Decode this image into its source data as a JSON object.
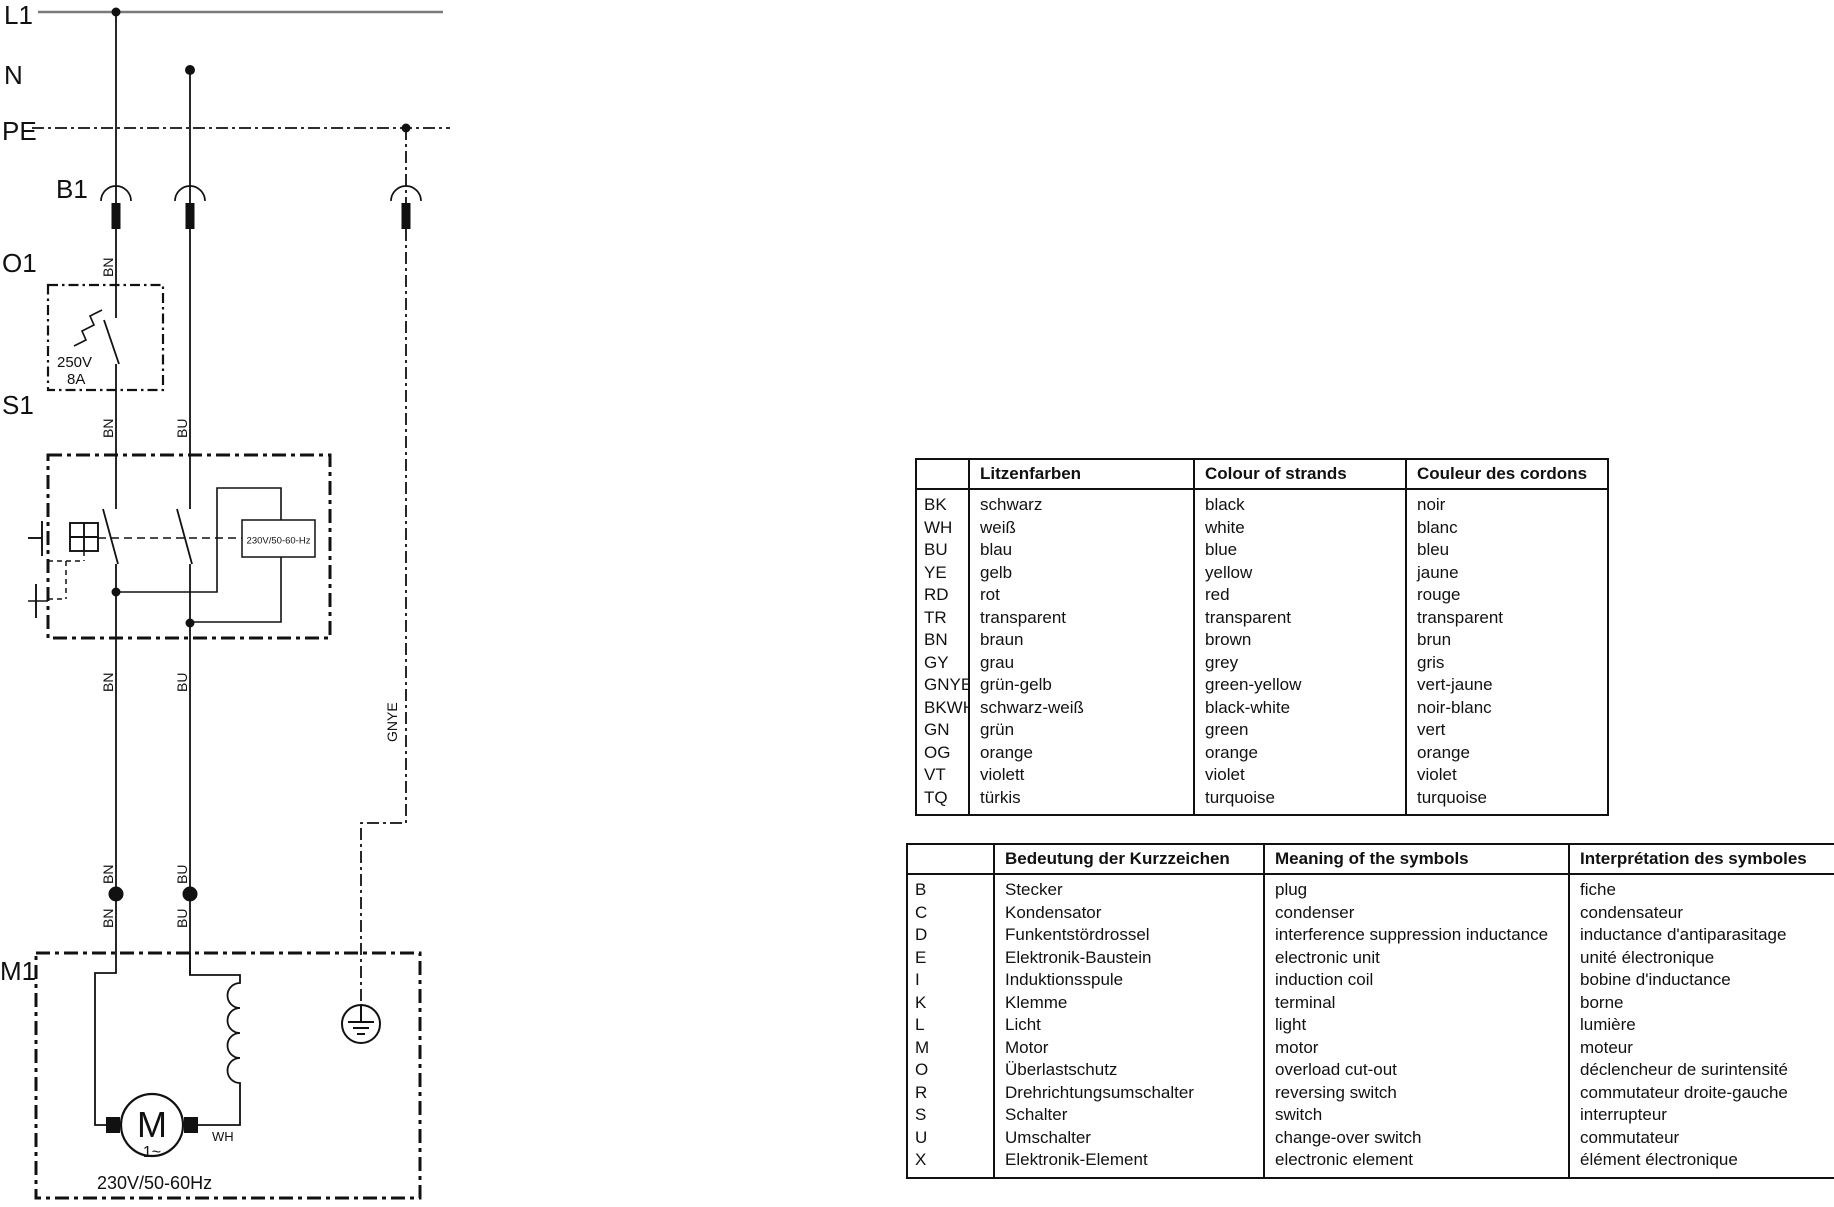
{
  "diagram": {
    "bus_labels": {
      "l1": "L1",
      "n": "N",
      "pe": "PE"
    },
    "ref_labels": {
      "b1": "B1",
      "o1": "O1",
      "s1": "S1",
      "m1": "M1"
    },
    "wire_labels": {
      "bn": "BN",
      "bu": "BU",
      "gnye": "GNYE",
      "wh": "WH"
    },
    "o1_rating": {
      "line1": "250V",
      "line2": "8A"
    },
    "s1_module_label": "230V/50-60-Hz",
    "motor": {
      "letter": "M",
      "phase": "1~",
      "rating": "230V/50-60Hz"
    }
  },
  "color_table": {
    "headers": [
      "",
      "Litzenfarben",
      "Colour of strands",
      "Couleur des cordons"
    ],
    "rows": [
      [
        "BK",
        "schwarz",
        "black",
        "noir"
      ],
      [
        "WH",
        "weiß",
        "white",
        "blanc"
      ],
      [
        "BU",
        "blau",
        "blue",
        "bleu"
      ],
      [
        "YE",
        "gelb",
        "yellow",
        "jaune"
      ],
      [
        "RD",
        "rot",
        "red",
        "rouge"
      ],
      [
        "TR",
        "transparent",
        "transparent",
        "transparent"
      ],
      [
        "BN",
        "braun",
        "brown",
        "brun"
      ],
      [
        "GY",
        "grau",
        "grey",
        "gris"
      ],
      [
        "GNYE",
        "grün-gelb",
        "green-yellow",
        "vert-jaune"
      ],
      [
        "BKWH",
        "schwarz-weiß",
        "black-white",
        "noir-blanc"
      ],
      [
        "GN",
        "grün",
        "green",
        "vert"
      ],
      [
        "OG",
        "orange",
        "orange",
        "orange"
      ],
      [
        "VT",
        "violett",
        "violet",
        "violet"
      ],
      [
        "TQ",
        "türkis",
        "turquoise",
        "turquoise"
      ]
    ]
  },
  "symbol_table": {
    "headers": [
      "",
      "Bedeutung der Kurzzeichen",
      "Meaning of the symbols",
      "Interprétation des symboles"
    ],
    "rows": [
      [
        "B",
        "Stecker",
        "plug",
        "fiche"
      ],
      [
        "C",
        "Kondensator",
        "condenser",
        "condensateur"
      ],
      [
        "D",
        "Funkentstördrossel",
        "interference suppression inductance",
        "inductance d'antiparasitage"
      ],
      [
        "E",
        "Elektronik-Baustein",
        "electronic unit",
        "unité électronique"
      ],
      [
        "I",
        "Induktionsspule",
        "induction coil",
        "bobine d'inductance"
      ],
      [
        "K",
        "Klemme",
        "terminal",
        "borne"
      ],
      [
        "L",
        "Licht",
        "light",
        "lumière"
      ],
      [
        "M",
        "Motor",
        "motor",
        "moteur"
      ],
      [
        "O",
        "Überlastschutz",
        "overload cut-out",
        "déclencheur de surintensité"
      ],
      [
        "R",
        "Drehrichtungsumschalter",
        "reversing switch",
        "commutateur droite-gauche"
      ],
      [
        "S",
        "Schalter",
        "switch",
        "interrupteur"
      ],
      [
        "U",
        "Umschalter",
        "change-over switch",
        "commutateur"
      ],
      [
        "X",
        "Elektronik-Element",
        "electronic element",
        "élément électronique"
      ]
    ]
  }
}
